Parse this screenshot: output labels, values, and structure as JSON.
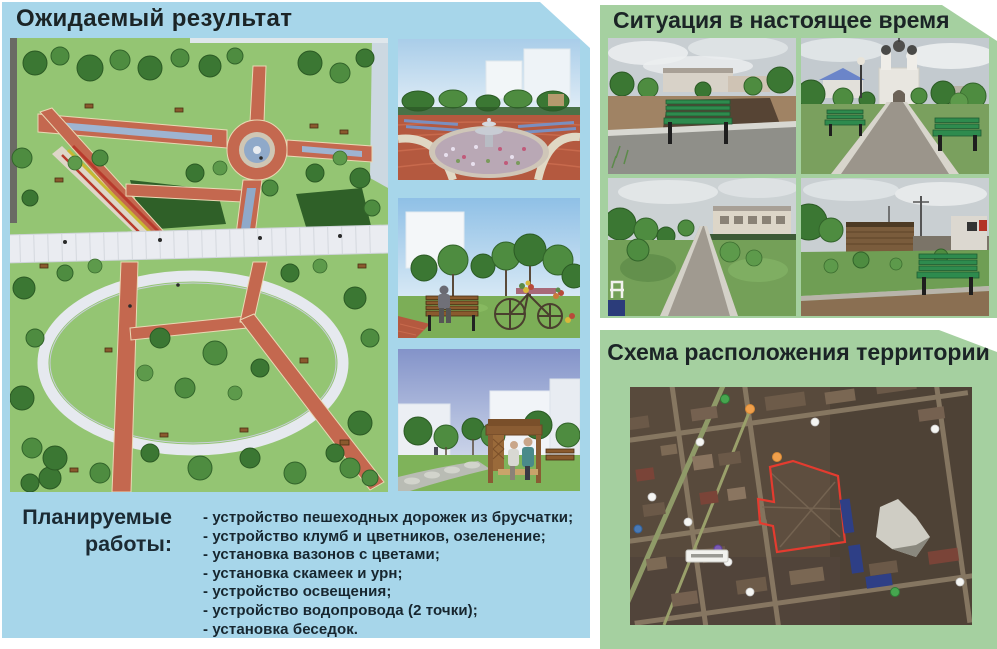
{
  "left_panel": {
    "title": "Ожидаемый результат",
    "background_color": "#a7d6ea",
    "renders": {
      "main": "park-plan-top-view-render",
      "small_1": "fountain-plaza-render",
      "small_2": "bench-and-flower-bicycle-render",
      "small_3": "wooden-gazebo-render"
    },
    "planned_works": {
      "label_line1": "Планируемые",
      "label_line2": "работы:",
      "items": [
        "- устройство пешеходных дорожек из брусчатки;",
        "- устройство клумб и цветников, озеленение;",
        "- установка вазонов с цветами;",
        "- установка скамеек и урн;",
        "- устройство освещения;",
        "- устройство водопровода (2 точки);",
        "- установка беседок."
      ]
    }
  },
  "top_right_panel": {
    "title": "Ситуация в настоящее время",
    "background_color": "#a5d0a0",
    "photos": [
      "green-bench-on-unpaved-ground",
      "paved-alley-to-church",
      "narrow-paved-footpath",
      "lawn-with-green-bench"
    ]
  },
  "bottom_right_panel": {
    "title": "Схема расположения территории",
    "background_color": "#a5d0a0",
    "map": {
      "type": "satellite-map",
      "territory_outline_color": "#e43b2f"
    }
  },
  "colors": {
    "title_text": "#1b2426",
    "list_text": "#17262f"
  }
}
